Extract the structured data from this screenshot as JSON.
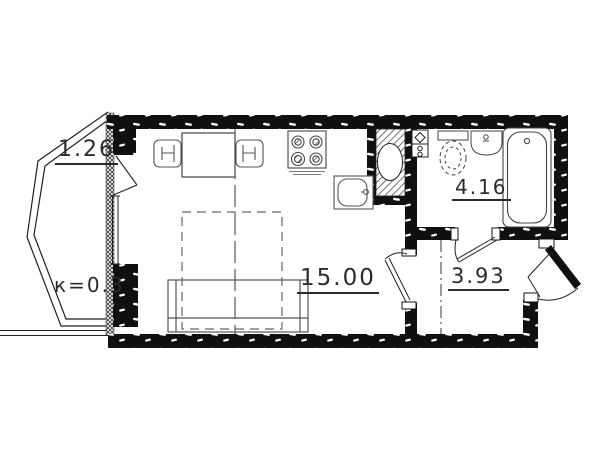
{
  "plan": {
    "background_color": "#ffffff",
    "line_color": "#1c1c1c",
    "rooms": {
      "balcony": {
        "area": "1.26",
        "coefficient": "к=0.3"
      },
      "living_room": {
        "area": "15.00"
      },
      "bathroom": {
        "area": "4.16"
      },
      "hallway": {
        "area": "3.93"
      }
    },
    "symbols": [
      "dining-table",
      "chair",
      "stove",
      "kitchen-sink",
      "ventilation-shaft",
      "plumbing-riser",
      "toilet",
      "washbasin",
      "bathtub",
      "sofa",
      "fold-out-bed",
      "balcony-door",
      "balcony-window",
      "room-door",
      "bathroom-door",
      "entrance-door"
    ]
  }
}
